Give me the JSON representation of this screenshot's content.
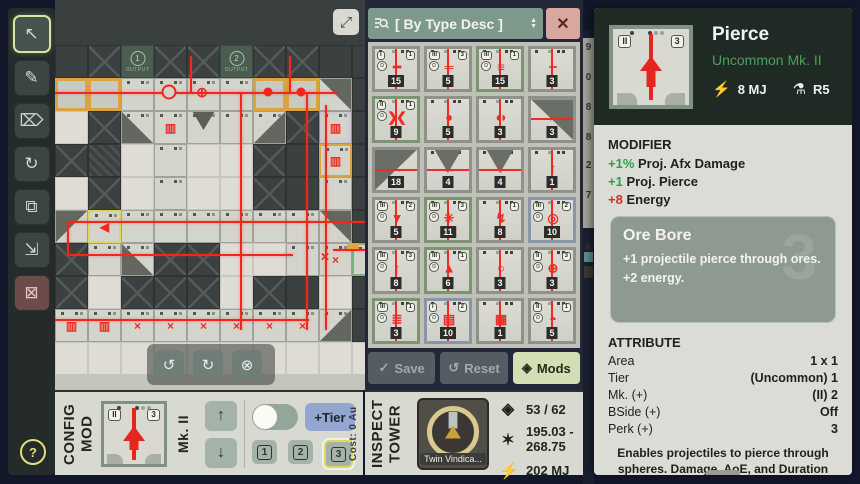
{
  "sidebar": {
    "tools": [
      {
        "name": "select-tool",
        "glyph": "↖",
        "active": true,
        "danger": false
      },
      {
        "name": "draw-tool",
        "glyph": "✎",
        "active": false,
        "danger": false
      },
      {
        "name": "erase-tool",
        "glyph": "⌦",
        "active": false,
        "danger": false
      },
      {
        "name": "rotate-auto-tool",
        "glyph": "↻",
        "active": false,
        "danger": false
      },
      {
        "name": "copy-tool",
        "glyph": "⧉",
        "active": false,
        "danger": false
      },
      {
        "name": "paste-tool",
        "glyph": "⇲",
        "active": false,
        "danger": false
      },
      {
        "name": "delete-tool",
        "glyph": "⊠",
        "active": false,
        "danger": true
      }
    ],
    "help_label": "?"
  },
  "map": {
    "expand_glyph": "⤢",
    "grid": [
      [
        "P",
        "X",
        "O1",
        "X",
        "X",
        "O2",
        "X",
        "X",
        "P",
        "P"
      ],
      [
        "T",
        "T",
        "M",
        "M",
        "M",
        "M",
        "T",
        "T",
        "Wa",
        "P"
      ],
      [
        "L",
        "X",
        "Wc",
        "B",
        "V",
        "M",
        "Wd",
        "X",
        "N",
        "P"
      ],
      [
        "X",
        "H",
        "L",
        "M",
        "L",
        "L",
        "X",
        "P",
        "G",
        "P"
      ],
      [
        "L",
        "X",
        "L",
        "M",
        "L",
        "L",
        "X",
        "P",
        "M",
        "P"
      ],
      [
        "Wb",
        "S",
        "M",
        "M",
        "M",
        "M",
        "M",
        "M",
        "Wa",
        "P"
      ],
      [
        "X",
        "M",
        "Wc",
        "X",
        "X",
        "L",
        "L",
        "M",
        "Q",
        "E"
      ],
      [
        "X",
        "L",
        "X",
        "X",
        "X",
        "L",
        "X",
        "P",
        "L",
        "P"
      ],
      [
        "R",
        "R",
        "K",
        "K",
        "K",
        "K",
        "K",
        "K",
        "Wd",
        "P"
      ],
      [
        "L",
        "L",
        "L",
        "L",
        "L",
        "L",
        "L",
        "L",
        "L",
        "L"
      ]
    ],
    "tile_defs": {
      "P": {
        "cls": "td"
      },
      "X": {
        "cls": "td diag"
      },
      "H": {
        "cls": "td hatch"
      },
      "O1": {
        "cls": "tout",
        "label": "1",
        "sub": "OUTPUT"
      },
      "O2": {
        "cls": "tout",
        "label": "2",
        "sub": "OUTPUT"
      },
      "T": {
        "cls": "ttw"
      },
      "M": {
        "cls": "tm"
      },
      "L": {
        "cls": "tl"
      },
      "Wa": {
        "cls": "tm wg wa"
      },
      "Wb": {
        "cls": "tm wg wb"
      },
      "Wc": {
        "cls": "tm wg wc"
      },
      "Wd": {
        "cls": "tm wg wd"
      },
      "V": {
        "cls": "tm vee"
      },
      "S": {
        "cls": "tm sel",
        "glyph": "◀"
      },
      "Q": {
        "cls": "tm",
        "glyph": "×"
      },
      "R": {
        "cls": "tm",
        "glyph": "▥"
      },
      "K": {
        "cls": "tm",
        "glyph": "×"
      },
      "E": {
        "cls": "tm gsel"
      },
      "B": {
        "cls": "tm",
        "glyph": "▥"
      },
      "N": {
        "cls": "tm violet",
        "glyph": "▥"
      },
      "G": {
        "cls": "tm torange",
        "glyph": "▥"
      }
    },
    "beams": {
      "h": [
        [
          0,
          92,
          282
        ],
        [
          12,
          221,
          298
        ],
        [
          12,
          254,
          226
        ],
        [
          0,
          319,
          254
        ],
        [
          278,
          249,
          32
        ]
      ],
      "v": [
        [
          12,
          221,
          34
        ],
        [
          135,
          56,
          38
        ],
        [
          234,
          56,
          38
        ],
        [
          185,
          92,
          238
        ],
        [
          251,
          92,
          238
        ],
        [
          270,
          105,
          225
        ]
      ]
    },
    "markers": [
      {
        "t": "ring",
        "x": 114,
        "y": 92
      },
      {
        "t": "cross",
        "x": 147,
        "y": 92
      },
      {
        "t": "dot",
        "x": 213,
        "y": 92
      },
      {
        "t": "dot",
        "x": 246,
        "y": 92
      },
      {
        "t": "xm",
        "x": 270,
        "y": 257
      },
      {
        "t": "orange",
        "x": 298,
        "y": 246
      }
    ],
    "toolbar": {
      "rotate_ccw": "↺",
      "rotate_cw": "↻",
      "cancel": "⊗"
    }
  },
  "mods_panel": {
    "search": {
      "label": "[ By Type Desc ]"
    },
    "items": [
      {
        "roman": "I",
        "num": "1",
        "gear": true,
        "count": "15",
        "glyph": "━",
        "frame": "gray",
        "kind": "v"
      },
      {
        "roman": "III",
        "num": "3",
        "gear": true,
        "count": "5",
        "glyph": "═",
        "frame": "gray",
        "kind": "v"
      },
      {
        "roman": "III",
        "num": "1",
        "gear": true,
        "count": "15",
        "glyph": "≡",
        "frame": "green",
        "kind": "v"
      },
      {
        "roman": "",
        "num": "",
        "gear": false,
        "count": "3",
        "glyph": "╌",
        "frame": "gray",
        "kind": "v"
      },
      {
        "roman": "II",
        "num": "1",
        "gear": true,
        "count": "9",
        "glyph": "❯❮",
        "frame": "green",
        "kind": "v"
      },
      {
        "roman": "",
        "num": "",
        "gear": false,
        "count": "5",
        "glyph": "●",
        "frame": "gray",
        "kind": "v"
      },
      {
        "roman": "",
        "num": "",
        "gear": false,
        "count": "3",
        "glyph": "◖◗",
        "frame": "gray",
        "kind": "v"
      },
      {
        "roman": "",
        "num": "",
        "gear": false,
        "count": "3",
        "glyph": "←",
        "frame": "gray",
        "kind": "wedge-ne"
      },
      {
        "roman": "",
        "num": "",
        "gear": false,
        "count": "18",
        "glyph": "→",
        "frame": "gray",
        "kind": "wedge-nw"
      },
      {
        "roman": "",
        "num": "",
        "gear": false,
        "count": "4",
        "glyph": "↔",
        "frame": "gray",
        "kind": "vee"
      },
      {
        "roman": "",
        "num": "",
        "gear": false,
        "count": "4",
        "glyph": "↑",
        "frame": "gray",
        "kind": "vee"
      },
      {
        "roman": "",
        "num": "",
        "gear": false,
        "count": "1",
        "glyph": "↑",
        "frame": "gray",
        "kind": "cross"
      },
      {
        "roman": "III",
        "num": "2",
        "gear": true,
        "count": "5",
        "glyph": "▼",
        "frame": "gray",
        "kind": "v"
      },
      {
        "roman": "III",
        "num": "3",
        "gear": true,
        "count": "11",
        "glyph": "✳",
        "frame": "green",
        "kind": "v"
      },
      {
        "roman": "",
        "num": "1",
        "gear": false,
        "count": "8",
        "glyph": "↯",
        "frame": "gray",
        "kind": "v"
      },
      {
        "roman": "III",
        "num": "2",
        "gear": true,
        "count": "10",
        "glyph": "◎",
        "frame": "blue",
        "kind": "v"
      },
      {
        "roman": "III",
        "num": "3",
        "gear": true,
        "count": "8",
        "glyph": "↑",
        "frame": "gray",
        "kind": "v"
      },
      {
        "roman": "III",
        "num": "1",
        "gear": true,
        "count": "6",
        "glyph": "▲",
        "frame": "green",
        "kind": "v"
      },
      {
        "roman": "",
        "num": "",
        "gear": false,
        "count": "3",
        "glyph": "○",
        "frame": "gray",
        "kind": "v"
      },
      {
        "roman": "II",
        "num": "3",
        "gear": true,
        "count": "3",
        "glyph": "⊕",
        "frame": "gray",
        "kind": "v"
      },
      {
        "roman": "III",
        "num": "1",
        "gear": true,
        "count": "3",
        "glyph": "≣",
        "frame": "green",
        "kind": "v"
      },
      {
        "roman": "I",
        "num": "2",
        "gear": true,
        "count": "10",
        "glyph": "▤",
        "frame": "blue",
        "kind": "v"
      },
      {
        "roman": "",
        "num": "",
        "gear": false,
        "count": "1",
        "glyph": "▦",
        "frame": "gray",
        "kind": "v"
      },
      {
        "roman": "II",
        "num": "1",
        "gear": true,
        "count": "5",
        "glyph": "◓",
        "frame": "gray",
        "kind": "v"
      }
    ],
    "footer": {
      "save": "Save",
      "reset": "Reset",
      "mods": "Mods",
      "save_icon": "✓",
      "reset_icon": "↺",
      "mods_icon": "◈"
    }
  },
  "side_strip": {
    "chars": [
      {
        "c": "9",
        "y": 12
      },
      {
        "c": "0",
        "y": 42
      },
      {
        "c": "8",
        "y": 72
      },
      {
        "c": "8",
        "y": 102
      },
      {
        "c": "2",
        "y": 130
      },
      {
        "c": "7",
        "y": 160
      },
      {
        "c": "k",
        "y": 212
      }
    ]
  },
  "detail_panel": {
    "title": "Pierce",
    "rarity": "Uncommon Mk. II",
    "energy_icon": "⚡",
    "energy": "8 MJ",
    "research_icon": "⚗",
    "research": "R5",
    "icon": {
      "left": "II",
      "right": "3"
    },
    "modifier": {
      "heading": "MODIFIER",
      "lines": [
        {
          "prefix": "+1%",
          "tone": "pos",
          "text": "Proj. Afx Damage"
        },
        {
          "prefix": "+1",
          "tone": "pos",
          "text": "Proj. Pierce"
        },
        {
          "prefix": "+8",
          "tone": "neg",
          "text": "Energy"
        }
      ]
    },
    "perk": {
      "title": "Ore Bore",
      "lines": [
        "+1 projectile pierce through ores.",
        "+2 energy."
      ],
      "watermark": "3"
    },
    "attributes": {
      "heading": "ATTRIBUTE",
      "rows": [
        [
          "Area",
          "1 x 1"
        ],
        [
          "Tier",
          "(Uncommon) 1"
        ],
        [
          "Mk. (+)",
          "(II) 2"
        ],
        [
          "BSide (+)",
          "Off"
        ],
        [
          "Perk (+)",
          "3"
        ]
      ]
    },
    "description": "Enables projectiles to pierce through spheres. Damage, AoE, and Duration are halved after each"
  },
  "config_mod": {
    "title_lines": [
      "CONFIG",
      "MOD"
    ],
    "preview": {
      "left": "II",
      "right": "3"
    },
    "mk_label": "Mk. II",
    "up_glyph": "↑",
    "down_glyph": "↓",
    "tier_button": "+Tier",
    "levels": [
      "1",
      "2",
      "3"
    ],
    "selected_level_index": 2,
    "cost_label": "Cost: 0 Au"
  },
  "inspect_tower": {
    "title_lines": [
      "INSPECT",
      "TOWER"
    ],
    "tower_name": "Twin Vindica...",
    "stats": [
      {
        "name": "mod-slots",
        "icon": "◈",
        "value": "53 / 62",
        "two_line": false
      },
      {
        "name": "damage-range",
        "icon": "✶",
        "value": "195.03 -|268.75",
        "two_line": true
      },
      {
        "name": "energy",
        "icon": "⚡",
        "value": "202 MJ",
        "two_line": false
      }
    ]
  }
}
